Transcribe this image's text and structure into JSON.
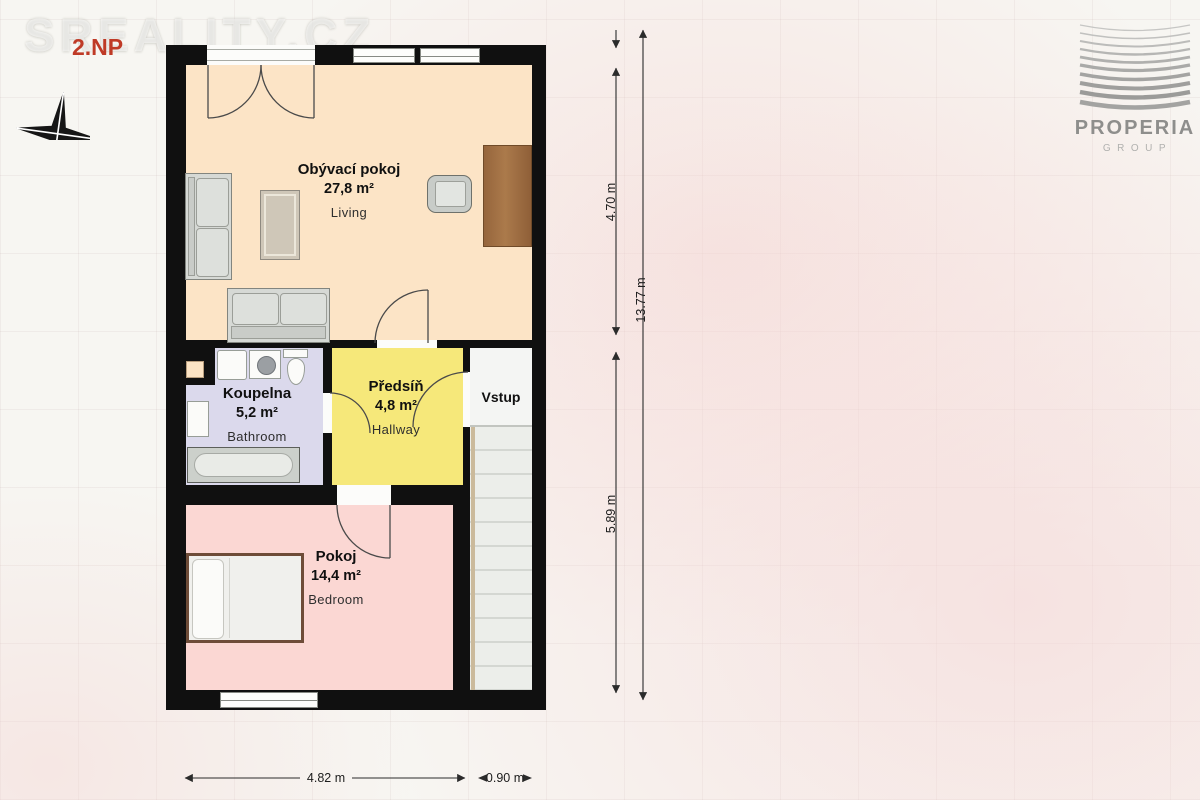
{
  "page": {
    "floor_label": "2.NP",
    "watermark": "SREALITY.CZ",
    "background_color": "#f7f6f2"
  },
  "branding": {
    "company": "PROPERIA",
    "division": "GROUP",
    "logo_color": "#8e8e8c"
  },
  "compass": {
    "north_label": "N"
  },
  "floorplan": {
    "wall_color": "#101010",
    "rooms": {
      "living": {
        "name": "Obývací pokoj",
        "area": "27,8 m²",
        "subtitle": "Living",
        "color": "#fce4c6"
      },
      "bathroom": {
        "name": "Koupelna",
        "area": "5,2 m²",
        "subtitle": "Bathroom",
        "color": "#dbd9ec"
      },
      "hallway": {
        "name": "Předsíň",
        "area": "4,8 m²",
        "subtitle": "Hallway",
        "color": "#f6e87a"
      },
      "entry": {
        "name": "Vstup",
        "color": "#f4f5f3"
      },
      "bedroom": {
        "name": "Pokoj",
        "area": "14,4 m²",
        "subtitle": "Bedroom",
        "color": "#fbd7d3"
      }
    }
  },
  "dimensions": {
    "right_inner_top": "4.70 m",
    "right_inner_bottom": "5.89 m",
    "right_total": "13.77 m",
    "bottom_width": "4.82 m",
    "bottom_entry_width": "0.90 m"
  }
}
